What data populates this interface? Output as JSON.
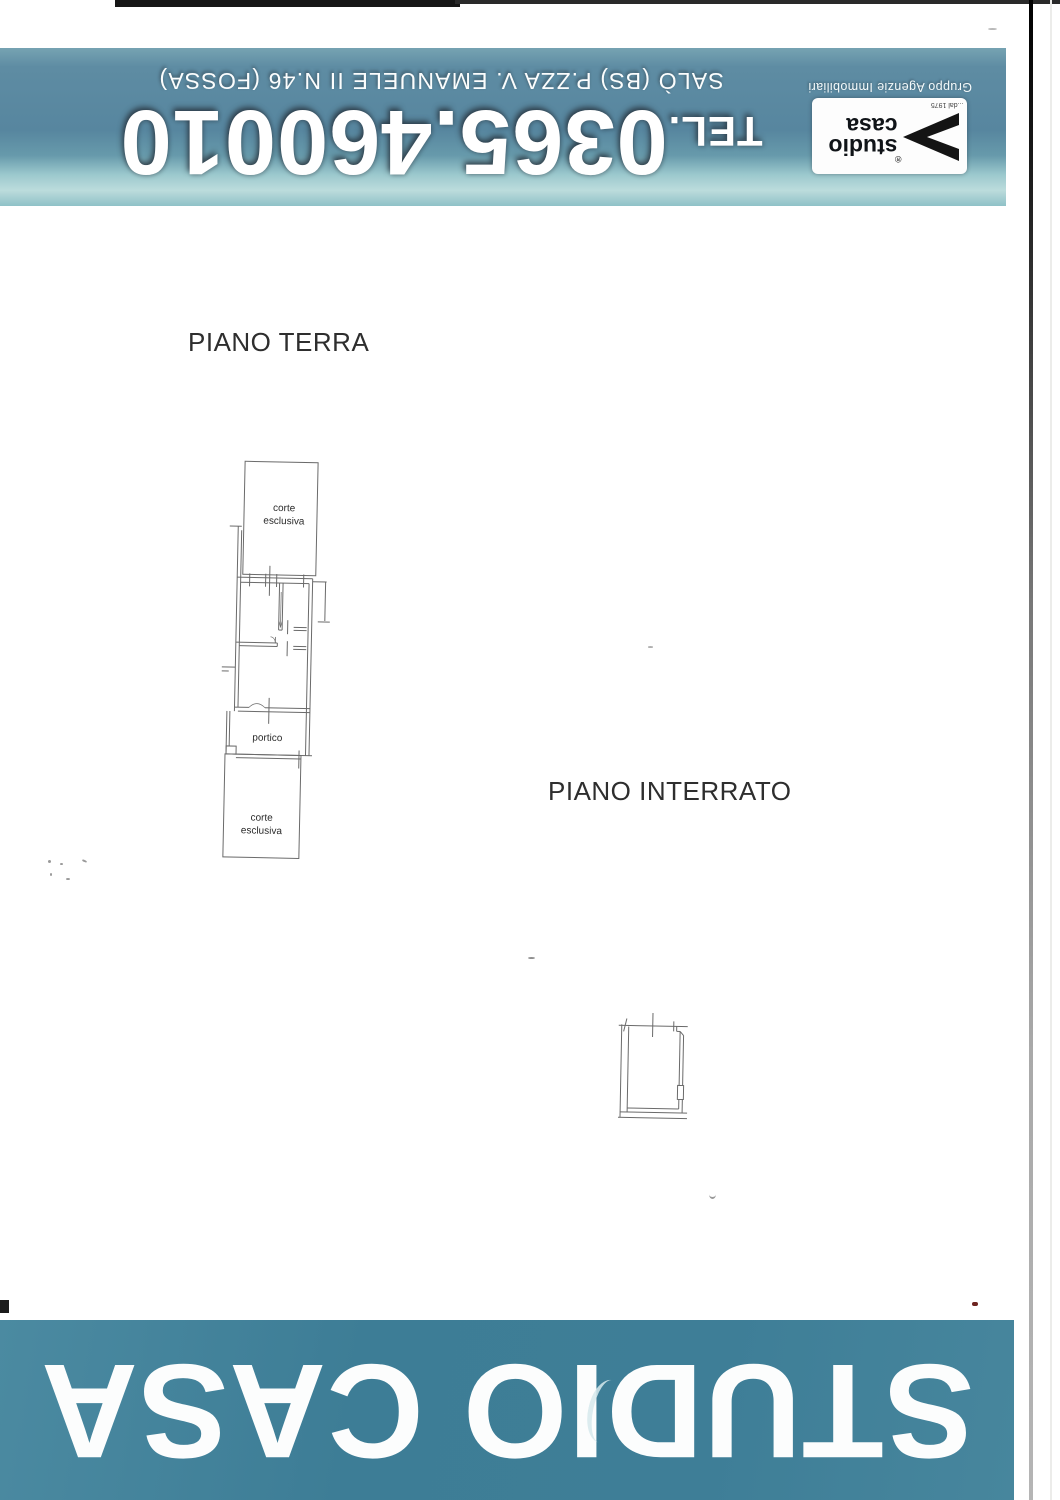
{
  "header": {
    "tel_label": "TEL.",
    "tel_number": "0365.460010",
    "address": "SALÒ (BS) P.ZZA V. EMANUELE II N.46 (FOSSA)",
    "logo": {
      "word1": "studio",
      "word2": "casa",
      "since": "...dal 1975",
      "registered": "®",
      "group": "Gruppo Agenzie Immobiliari"
    }
  },
  "plans": {
    "ground": {
      "title": "PIANO TERRA",
      "court_top": {
        "l1": "corte",
        "l2": "esclusiva"
      },
      "portico": "portico",
      "court_bottom": {
        "l1": "corte",
        "l2": "esclusiva"
      }
    },
    "basement": {
      "title": "PIANO INTERRATO"
    }
  },
  "footer": {
    "text": "STUDIO CASA"
  },
  "colors": {
    "banner_teal": "#57869f",
    "banner_light_teal": "#9bc8cd",
    "footer_teal": "#3e7e97",
    "plan_line_gray": "#6a6a6a",
    "text_white": "#fcfdfd"
  }
}
